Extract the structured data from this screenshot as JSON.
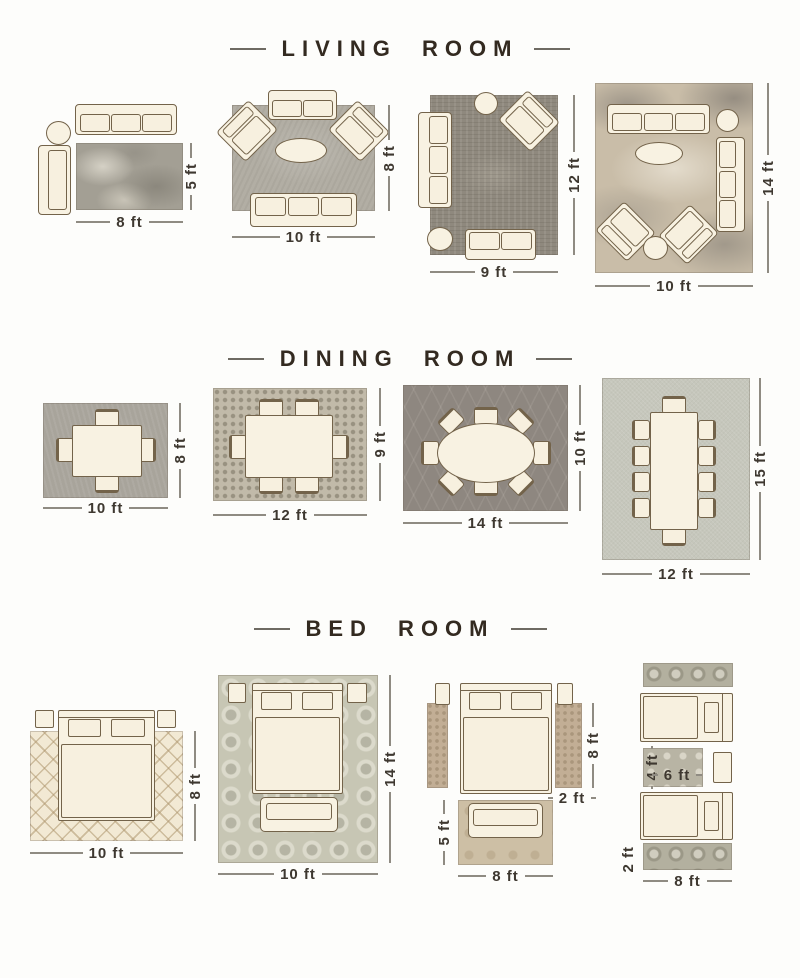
{
  "sections": [
    {
      "title": "LIVING ROOM",
      "layouts": [
        {
          "name": "living-sofa-chair",
          "width_label": "8 ft",
          "height_label": "5 ft"
        },
        {
          "name": "living-two-sofas-two-chairs",
          "width_label": "10 ft",
          "height_label": "8 ft"
        },
        {
          "name": "living-sectional",
          "width_label": "9 ft",
          "height_label": "12 ft"
        },
        {
          "name": "living-large",
          "width_label": "10 ft",
          "height_label": "14 ft"
        }
      ]
    },
    {
      "title": "DINING ROOM",
      "layouts": [
        {
          "name": "dining-4-seats",
          "width_label": "10 ft",
          "height_label": "8 ft"
        },
        {
          "name": "dining-6-seats",
          "width_label": "12 ft",
          "height_label": "9 ft"
        },
        {
          "name": "dining-oval-8-seats",
          "width_label": "14 ft",
          "height_label": "10 ft"
        },
        {
          "name": "dining-10-seats",
          "width_label": "12 ft",
          "height_label": "15 ft"
        }
      ]
    },
    {
      "title": "BED ROOM",
      "layouts": [
        {
          "name": "bed-rug-under",
          "width_label": "10 ft",
          "height_label": "8 ft"
        },
        {
          "name": "bed-full-rug-with-bench",
          "width_label": "10 ft",
          "height_label": "14 ft"
        },
        {
          "name": "bed-side-runners",
          "runner_height_label": "8 ft",
          "runner_width_label": "2 ft",
          "bench_rug_height_label": "5 ft",
          "bench_rug_width_label": "8 ft"
        },
        {
          "name": "twin-beds-runners",
          "small_rug_height_label": "4 ft",
          "small_rug_width_label": "6 ft",
          "runner_height_label": "2 ft",
          "runner_width_label": "8 ft"
        }
      ]
    }
  ],
  "colors": {
    "background": "#fdfdfb",
    "title_text": "#332a20",
    "dimension_text": "#3e3830",
    "dimension_line": "#8f8b82",
    "furniture_fill": "#f8f2e2",
    "furniture_outline": "#73634a",
    "rug_gray": "#a39f94",
    "rug_dark_gray": "#8e8780",
    "rug_sage": "#c6c7bc",
    "rug_cream_diamond": "#f2e9d4",
    "rug_tan_runner": "#c2ae95",
    "rug_medallion": "#b3b09f"
  }
}
